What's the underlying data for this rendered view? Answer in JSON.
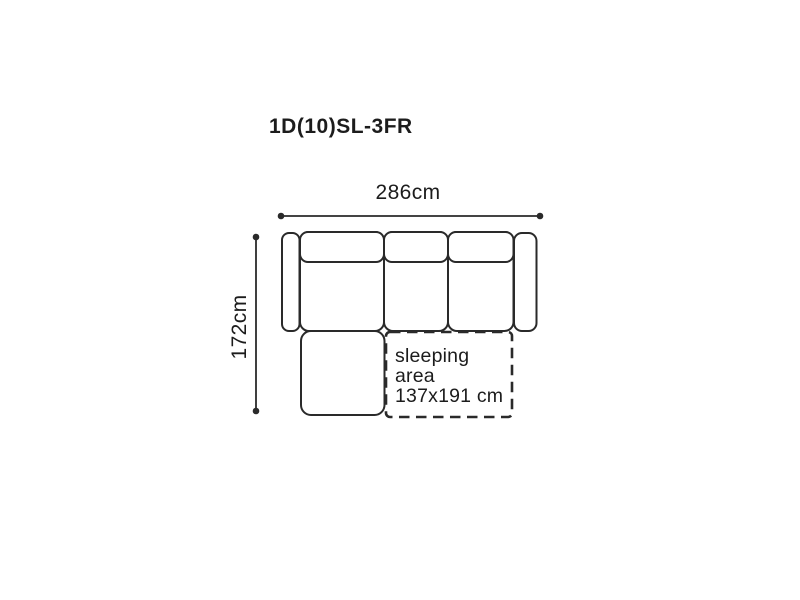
{
  "title": "1D(10)SL-3FR",
  "dimensions": {
    "width": {
      "label": "286cm"
    },
    "height": {
      "label": "172cm"
    }
  },
  "sleeping_area": {
    "line1": "sleeping",
    "line2": "area",
    "line3": "137x191 cm"
  },
  "colors": {
    "line": "#2a2a2a",
    "text": "#1c1c1c",
    "background": "#ffffff"
  }
}
